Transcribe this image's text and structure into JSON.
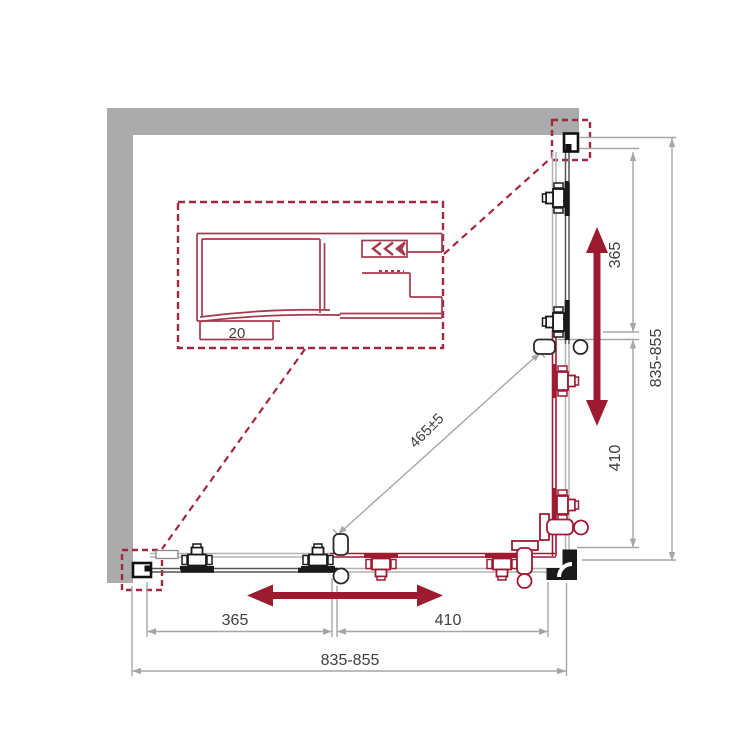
{
  "drawing": {
    "type": "shower-enclosure-corner-plan",
    "dims": {
      "bottom_near_wall": "365",
      "bottom_near_corner": "410",
      "bottom_total": "835-855",
      "right_near_wall": "365",
      "right_near_corner": "410",
      "right_total": "835-855",
      "diagonal_opening": "465±5",
      "profile_depth": "20"
    },
    "colors": {
      "wall_gray": "#ababab",
      "hardware_red": "#9e1b32",
      "detail_red": "#a43a4e",
      "callout_red": "#a02840",
      "dim_gray": "#a6a6a6",
      "black": "#1a1a1a",
      "text": "#3f3f3f"
    }
  }
}
